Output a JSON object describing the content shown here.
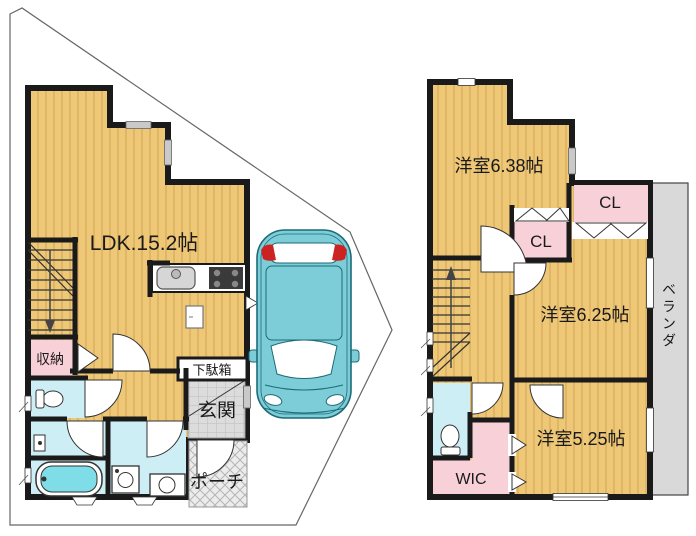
{
  "floor1": {
    "ldk": "LDK.15.2帖",
    "storage": "収納",
    "shoe_box": "下駄箱",
    "entrance": "玄関",
    "porch": "ポーチ"
  },
  "floor2": {
    "room_a": "洋室6.38帖",
    "closet_a": "CL",
    "closet_b": "CL",
    "room_b": "洋室6.25帖",
    "room_c": "洋室5.25帖",
    "walk_in_closet": "WIC",
    "veranda": "ベランダ"
  },
  "colors": {
    "wall": "#1a1a1a",
    "floor_yellow": "#eec877",
    "floor_stripe": "#d9ae5e",
    "room_pink": "#f8d0d8",
    "room_cyan": "#cdeef4",
    "tub_cyan": "#7fdde8",
    "entrance_gray": "#dcdcdc",
    "veranda_gray": "#d9d9d9",
    "car_teal": "#7ccdd8",
    "car_outline": "#1d6a77",
    "car_light_red": "#cc2222"
  }
}
